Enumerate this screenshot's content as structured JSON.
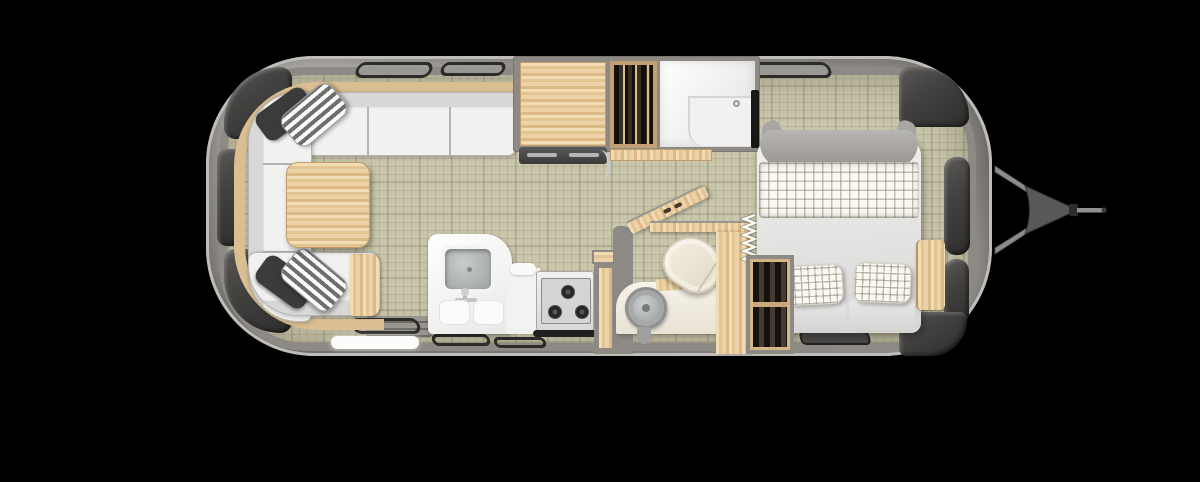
{
  "scene": {
    "title": "Travel trailer floor plan — top-down view",
    "view": "top-down cutaway render",
    "hitch_side": "right",
    "text_visible": "none"
  },
  "colors": {
    "background": "#000000",
    "shell_light": "#c6c4c0",
    "shell_dark": "#8e8b87",
    "wall": "#8d8a86",
    "floor": "#c9c6ab",
    "wood_light": "#f0d9b1",
    "wood_dark": "#d9b886",
    "upholstery_light": "#f1f1ef",
    "upholstery_dark": "#d8d8d6",
    "pillow_dark": "#3b3b3b",
    "plaid_base": "#faf8f1",
    "window_dark": "#434241",
    "fixture_white": "#f7f7f5",
    "wardrobe_interior": "#241e18",
    "toilet_cream": "#f0e9dc",
    "metal_gray": "#9a9a98"
  },
  "features": {
    "shell": "Trailer shell",
    "floor": "Interior floor",
    "hitch": "Tow hitch and A-frame",
    "lounge_sofa": "Wraparound lounge seating",
    "lounge_table": "Dinette table",
    "pillow_striped": "Striped accent pillow",
    "pillow_dark": "Charcoal accent pillow",
    "galley_counter": "Galley countertop",
    "oven": "Oven front",
    "wardrobe": "Wardrobe with hanging clothes",
    "shower": "Shower room",
    "kitchen_counter": "Kitchen sink counter",
    "kitchen_sink": "Kitchen sink",
    "cooktop": "Range cooktop",
    "stove_handle": "Oven handle",
    "bath_wall": "Bathroom partition wall",
    "bath_door": "Open bathroom door",
    "toilet": "Toilet",
    "bath_sink": "Round bathroom sink",
    "vanity": "Bathroom vanity",
    "shelf": "Wood shelf",
    "accordion_door": "Accordion privacy screen",
    "bed": "Bed with duvet",
    "bed_plaid": "Plaid bed runner",
    "bed_pillow": "Plaid pillow",
    "foot_cushion": "Bed cushion",
    "headboard": "Upholstered headboard",
    "nightstand": "Bedside wood cabinet",
    "bed_wardrobe": "Bedroom wardrobe",
    "tv": "Wall-mounted TV",
    "entry_step": "Entry door step",
    "steps": "Entry stairs",
    "window": "Window",
    "vent": "Vent / step outline",
    "mat": "Floor mat",
    "cabinet": "Cabinet"
  }
}
